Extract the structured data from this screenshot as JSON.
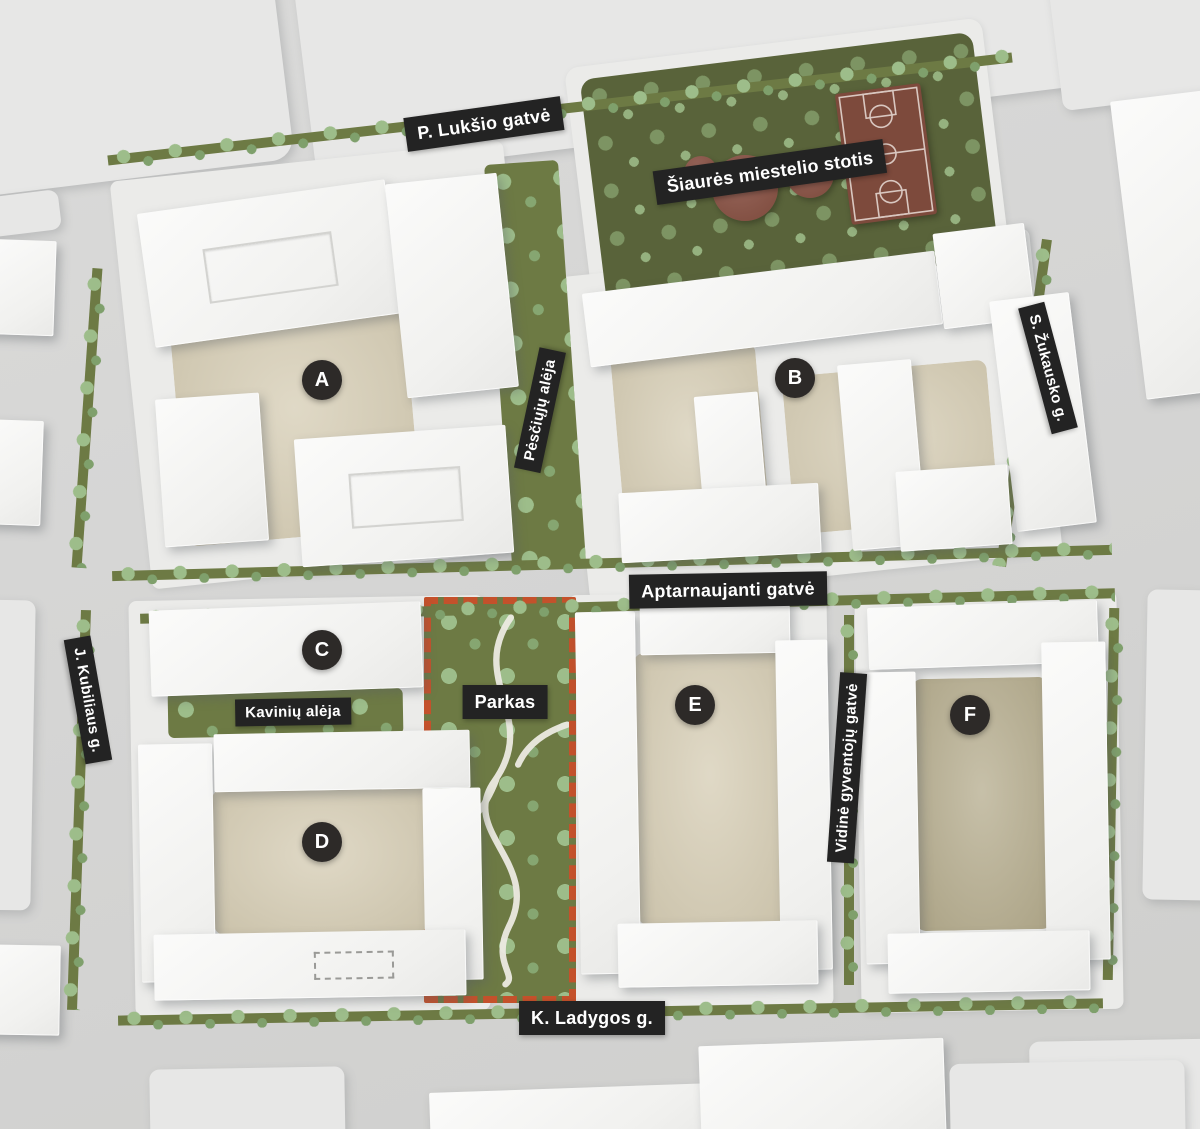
{
  "plan": {
    "streets": {
      "p_luksio": "P. Lukšio gatvė",
      "s_zukausko": "S. Žukausko g.",
      "aptarnaujanti": "Aptarnaujanti gatvė",
      "j_kubiliaus": "J. Kubiliaus g.",
      "k_ladygos": "K. Ladygos g.",
      "vidine": "Vidinė gyventojų gatvė",
      "pesciuju": "Pėsčiųjų alėja",
      "kaviniu": "Kavinių alėja"
    },
    "areas": {
      "stotis": "Šiaurės miestelio stotis",
      "parkas": "Parkas"
    },
    "blocks": {
      "a": "A",
      "b": "B",
      "c": "C",
      "d": "D",
      "e": "E",
      "f": "F"
    },
    "colors": {
      "label_bg": "#232323",
      "label_text": "#ffffff",
      "marker_bg": "#2d2a28",
      "park_border": "#c4512b",
      "greenery": "#6d7a44",
      "tree": "#9dbd8a",
      "court": "#7d4a3c",
      "courtyard": "#d5ccb3"
    }
  }
}
